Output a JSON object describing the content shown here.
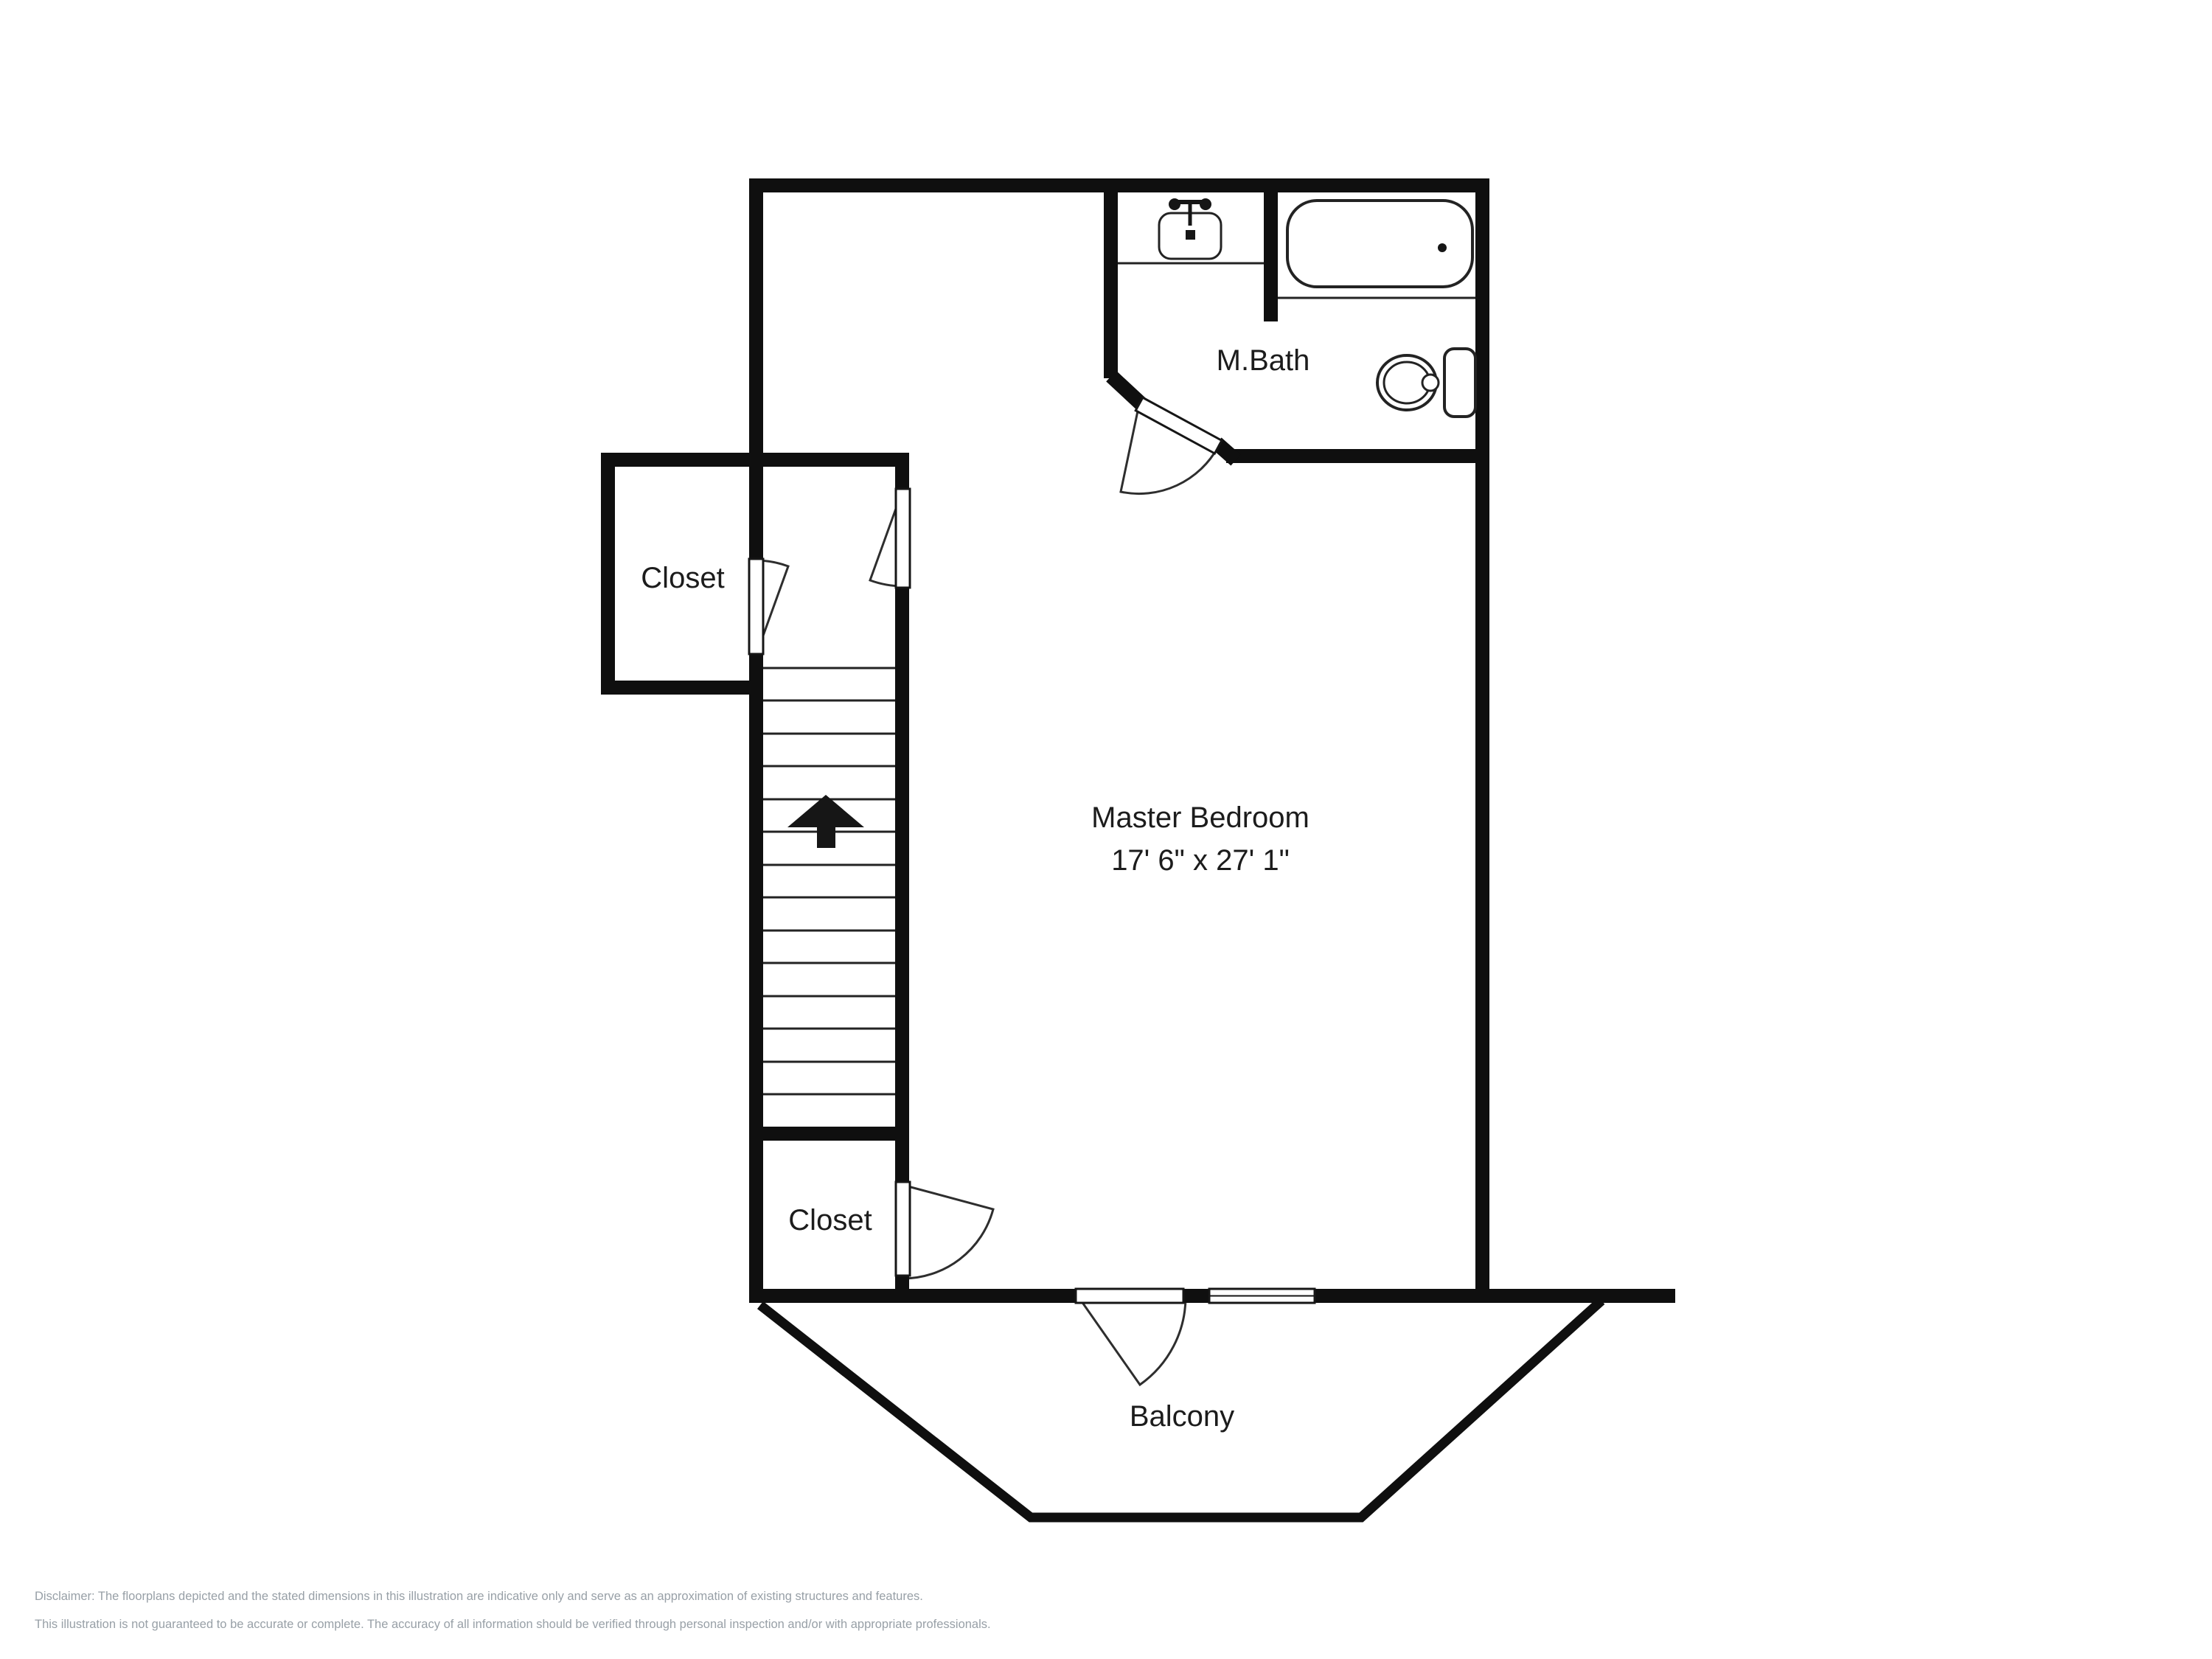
{
  "floorplan": {
    "labels": {
      "master_bedroom_name": "Master Bedroom",
      "master_bedroom_dims": "17' 6\" x 27' 1\"",
      "master_bath": "M.Bath",
      "closet_upper": "Closet",
      "closet_lower": "Closet",
      "balcony": "Balcony"
    },
    "colors": {
      "background": "#ffffff",
      "wall": "#0f0f0f",
      "line": "#232323",
      "label_text": "#1c1c1c",
      "disclaimer_text": "#98a0a7"
    }
  },
  "disclaimer": {
    "line1": "Disclaimer: The floorplans depicted and the stated dimensions in this illustration are indicative only and serve as an approximation of existing structures and features.",
    "line2": "This illustration is not guaranteed to be accurate or complete. The accuracy of all information should be verified through personal inspection and/or with appropriate professionals."
  }
}
